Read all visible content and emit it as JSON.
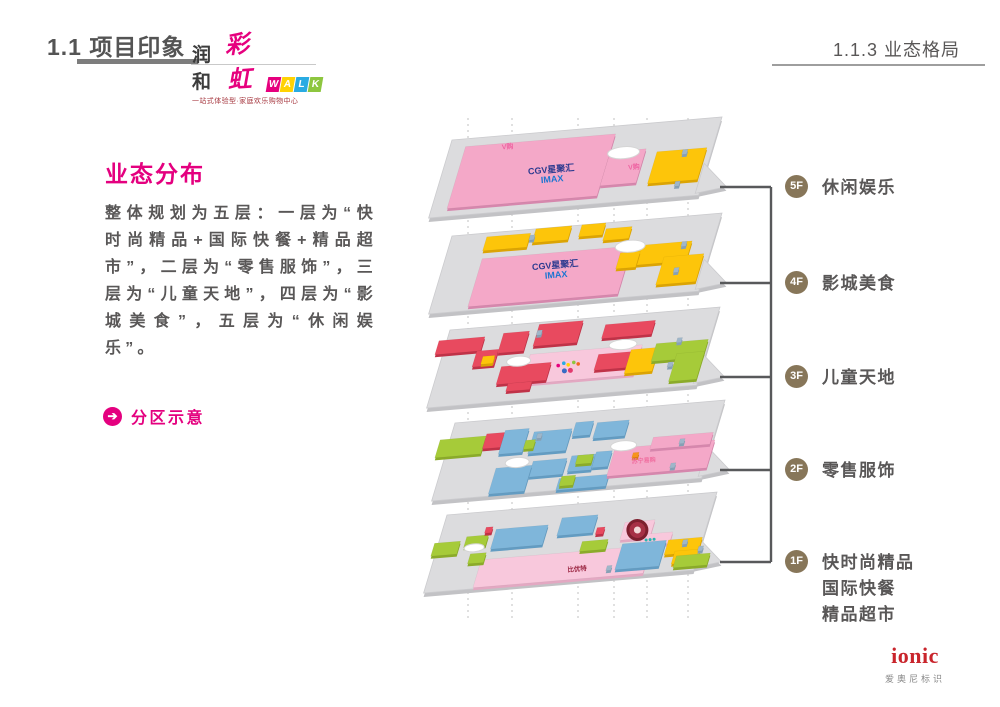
{
  "slide": {
    "section_title": "1.1 项目印象",
    "page_title": "1.1.3 业态格局"
  },
  "logo": {
    "name_cn_1": "润和",
    "name_cn_2": "彩虹",
    "letters": [
      {
        "char": "W",
        "bg": "#e6007e"
      },
      {
        "char": "A",
        "bg": "#ffd203"
      },
      {
        "char": "L",
        "bg": "#29abe2"
      },
      {
        "char": "K",
        "bg": "#8dc63f"
      }
    ],
    "tagline": "一站式体验型·家庭欢乐购物中心"
  },
  "content": {
    "title": "业态分布",
    "paragraph": "整体规划为五层：一层为“快时尚精品+国际快餐+精品超市”，二层为“零售服饰”，三层为“儿童天地”，四层为“影城美食”，五层为“休闲娱乐”。",
    "callout": "分区示意"
  },
  "diagram": {
    "guide_lines_x": [
      468,
      512,
      578,
      614,
      647,
      688
    ],
    "bracket": {
      "x": 771,
      "top": 187,
      "bottom": 562,
      "stub_start": 720,
      "color": "#58595b"
    },
    "floors": [
      {
        "badge": "5F",
        "label_lines": [
          "休闲娱乐"
        ],
        "origin": [
          452,
          140
        ],
        "stub_y": 187,
        "blocks": [
          [
            16,
            8,
            150,
            62,
            "pink"
          ],
          [
            166,
            26,
            36,
            34,
            "pink"
          ],
          [
            214,
            30,
            50,
            32,
            "yellow"
          ],
          [
            240,
            30,
            5,
            5,
            "tag"
          ],
          [
            242,
            62,
            5,
            5,
            "tag"
          ]
        ],
        "ellipses": [
          [
            180,
            28,
            16,
            6
          ]
        ],
        "dots": [],
        "texts": [
          [
            "V购",
            60,
            14,
            "#ee66a3",
            7
          ],
          [
            "CGV星聚汇",
            112,
            42,
            "#2b3a8f",
            9
          ],
          [
            "IMAX",
            116,
            52,
            "#1b75d1",
            9
          ],
          [
            "V购",
            196,
            46,
            "#ee66a3",
            7
          ]
        ]
      },
      {
        "badge": "4F",
        "label_lines": [
          "影城美食"
        ],
        "origin": [
          452,
          236
        ],
        "stub_y": 283,
        "blocks": [
          [
            38,
            26,
            150,
            48,
            "pink"
          ],
          [
            36,
            4,
            44,
            14,
            "yellow"
          ],
          [
            84,
            0,
            36,
            14,
            "yellow"
          ],
          [
            130,
            0,
            24,
            12,
            "yellow"
          ],
          [
            156,
            6,
            26,
            12,
            "yellow"
          ],
          [
            192,
            26,
            56,
            20,
            "yellow"
          ],
          [
            224,
            40,
            40,
            28,
            "yellow"
          ],
          [
            178,
            32,
            20,
            16,
            "yellow"
          ],
          [
            80,
            6,
            5,
            5,
            "tag"
          ],
          [
            238,
            26,
            5,
            5,
            "tag"
          ],
          [
            238,
            52,
            5,
            5,
            "tag"
          ]
        ],
        "ellipses": [
          [
            186,
            26,
            15,
            6
          ]
        ],
        "dots": [],
        "texts": [
          [
            "CGV星聚汇",
            116,
            42,
            "#2b3a8f",
            9
          ],
          [
            "IMAX",
            120,
            52,
            "#1b75d1",
            9
          ]
        ]
      },
      {
        "badge": "3F",
        "label_lines": [
          "儿童天地"
        ],
        "origin": [
          450,
          330
        ],
        "stub_y": 377,
        "blocks": [
          [
            -8,
            10,
            46,
            14,
            "red"
          ],
          [
            34,
            24,
            22,
            16,
            "red"
          ],
          [
            56,
            8,
            26,
            20,
            "red"
          ],
          [
            90,
            2,
            44,
            22,
            "red"
          ],
          [
            158,
            8,
            50,
            14,
            "red"
          ],
          [
            90,
            32,
            112,
            30,
            "lightpink"
          ],
          [
            160,
            38,
            34,
            16,
            "red"
          ],
          [
            64,
            42,
            50,
            18,
            "red"
          ],
          [
            76,
            60,
            24,
            8,
            "red"
          ],
          [
            42,
            30,
            12,
            8,
            "yellow"
          ],
          [
            192,
            36,
            28,
            24,
            "yellow"
          ],
          [
            216,
            32,
            52,
            18,
            "green"
          ],
          [
            240,
            44,
            28,
            28,
            "green"
          ],
          [
            90,
            8,
            5,
            5,
            "tag"
          ],
          [
            236,
            28,
            5,
            5,
            "tag"
          ],
          [
            234,
            52,
            5,
            5,
            "tag"
          ]
        ],
        "ellipses": [
          [
            80,
            38,
            12,
            5
          ],
          [
            182,
            30,
            14,
            5
          ]
        ],
        "dots": [
          [
            122,
            46,
            1.8,
            "#e6007e"
          ],
          [
            127,
            44,
            1.8,
            "#29abe2"
          ],
          [
            132,
            46,
            1.8,
            "#ffd203"
          ],
          [
            137,
            44,
            1.8,
            "#8dc63f"
          ],
          [
            142,
            46,
            1.8,
            "#f26522"
          ],
          [
            130,
            52,
            2.5,
            "#3a6bc4"
          ],
          [
            136,
            52,
            2.5,
            "#e23a6e"
          ]
        ],
        "texts": []
      },
      {
        "badge": "2F",
        "label_lines": [
          "零售服饰"
        ],
        "origin": [
          455,
          423
        ],
        "stub_y": 470,
        "blocks": [
          [
            -10,
            16,
            46,
            18,
            "green"
          ],
          [
            36,
            14,
            18,
            15,
            "red"
          ],
          [
            54,
            12,
            24,
            24,
            "blue"
          ],
          [
            84,
            16,
            38,
            22,
            "blue"
          ],
          [
            124,
            10,
            18,
            14,
            "blue"
          ],
          [
            146,
            12,
            32,
            16,
            "blue"
          ],
          [
            92,
            46,
            34,
            16,
            "blue"
          ],
          [
            130,
            44,
            24,
            16,
            "blue"
          ],
          [
            56,
            50,
            36,
            26,
            "blue"
          ],
          [
            124,
            66,
            50,
            12,
            "blue"
          ],
          [
            154,
            42,
            16,
            16,
            "blue"
          ],
          [
            78,
            24,
            10,
            9,
            "green"
          ],
          [
            136,
            44,
            16,
            9,
            "green"
          ],
          [
            126,
            64,
            14,
            10,
            "green"
          ],
          [
            172,
            40,
            100,
            28,
            "pink"
          ],
          [
            208,
            32,
            60,
            12,
            "pink"
          ],
          [
            192,
            46,
            6,
            5,
            "orange"
          ],
          [
            88,
            18,
            5,
            5,
            "tag"
          ],
          [
            236,
            36,
            5,
            5,
            "tag"
          ],
          [
            234,
            60,
            5,
            5,
            "tag"
          ]
        ],
        "ellipses": [
          [
            76,
            46,
            12,
            5
          ],
          [
            180,
            38,
            13,
            5
          ]
        ],
        "dots": [],
        "texts": [
          [
            "苏宁易购",
            206,
            57,
            "#f06fa0",
            6
          ]
        ]
      },
      {
        "badge": "1F",
        "label_lines": [
          "快时尚精品",
          "国际快餐",
          "精品超市"
        ],
        "origin": [
          447,
          515
        ],
        "stub_y": 562,
        "blocks": [
          [
            49,
            49,
            170,
            28,
            "lightpink"
          ],
          [
            -4,
            28,
            26,
            13,
            "green"
          ],
          [
            27,
            24,
            22,
            11,
            "green"
          ],
          [
            55,
            19,
            52,
            20,
            "blue"
          ],
          [
            119,
            13,
            36,
            18,
            "blue"
          ],
          [
            147,
            39,
            26,
            10,
            "green"
          ],
          [
            36,
            42,
            16,
            10,
            "green"
          ],
          [
            185,
            23,
            30,
            18,
            "lightpink"
          ],
          [
            207,
            37,
            30,
            12,
            "lightpink"
          ],
          [
            189,
            45,
            44,
            26,
            "blue"
          ],
          [
            235,
            45,
            34,
            15,
            "yellow"
          ],
          [
            245,
            57,
            26,
            13,
            "yellow"
          ],
          [
            248,
            62,
            34,
            12,
            "green"
          ],
          [
            158,
            26,
            8,
            7,
            "red"
          ],
          [
            44,
            16,
            7,
            6,
            "red"
          ],
          [
            250,
            46,
            5,
            5,
            "tag"
          ],
          [
            180,
            66,
            5,
            5,
            "tag"
          ],
          [
            268,
            54,
            5,
            5,
            "tag"
          ]
        ],
        "ellipses": [
          [
            38,
            36,
            10,
            4
          ]
        ],
        "dots": [
          [
            200,
            32,
            11,
            "#7d1f2e"
          ],
          [
            200,
            32,
            8,
            "#a63045"
          ],
          [
            200,
            32,
            3.5,
            "#f2d8d8"
          ],
          [
            212,
            43,
            1.5,
            "#2ab5b0"
          ],
          [
            216,
            43,
            1.5,
            "#2ab5b0"
          ],
          [
            220,
            43,
            1.5,
            "#2ab5b0"
          ]
        ],
        "texts": [
          [
            "比优特",
            151,
            69,
            "#9c2844",
            6.5
          ]
        ]
      }
    ]
  },
  "footer": {
    "brand": "ionic",
    "brand_sub": "爱奥尼标识"
  },
  "colors": {
    "accent": "#e4007f",
    "badge": "#877659",
    "plate": "#dcdcde",
    "plate_side": "#c2c2c5",
    "plate_stroke": "#cbcbce",
    "pink": "#f4a8c8",
    "pink_dark": "#d687ad",
    "lightpink": "#f8c8dc",
    "lightpink_dark": "#e3a8c2",
    "yellow": "#fdc50a",
    "yellow_dark": "#dca404",
    "red": "#e84a5f",
    "red_dark": "#c03248",
    "green": "#a6cb39",
    "green_dark": "#8bab2a",
    "blue": "#7fb6da",
    "blue_dark": "#639cc2",
    "orange": "#f7941d",
    "orange_dark": "#d97b0d",
    "tag": "#9fb6c9",
    "tag_dark": "#86a0b5"
  }
}
